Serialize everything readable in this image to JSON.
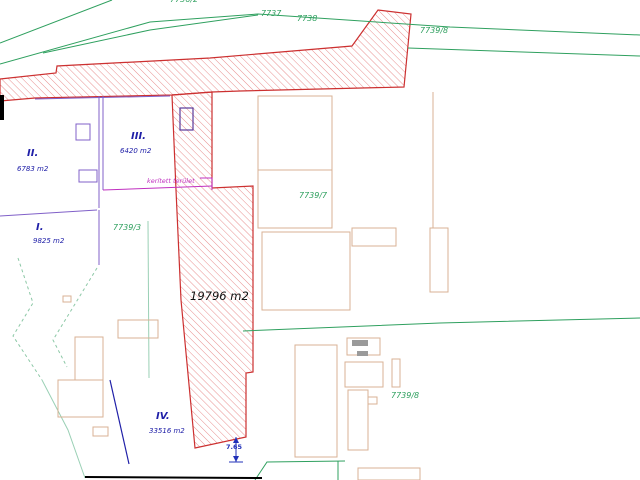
{
  "map": {
    "type": "cadastral-survey-drawing",
    "parcel_numbers": {
      "p7736_2": "7736/2",
      "p7737": "7737",
      "p7738": "7738",
      "p7739_8_top": "7739/8",
      "p7739_7": "7739/7",
      "p7739_3": "7739/3",
      "p7739_8_bottom": "7739/8"
    },
    "zones": {
      "zone1": {
        "numeral": "I.",
        "area": "9825 m2"
      },
      "zone2": {
        "numeral": "II.",
        "area": "6783 m2"
      },
      "zone3": {
        "numeral": "III.",
        "area": "6420 m2"
      },
      "zone4": {
        "numeral": "IV.",
        "area": "33516 m2"
      }
    },
    "hatched_parcel_area": "19796 m2",
    "note": "kerített terület",
    "dimension": "7.65"
  },
  "colors": {
    "boundary-green": "#2fa05f",
    "label-blue": "#2020a8",
    "hatch-red": "#e89090",
    "outline-red": "#cc3030",
    "magenta": "#c030c0",
    "violet": "#8060c8",
    "building-tan": "#d8b294",
    "dimension-blue": "#2030b8",
    "text-black": "#101010"
  }
}
